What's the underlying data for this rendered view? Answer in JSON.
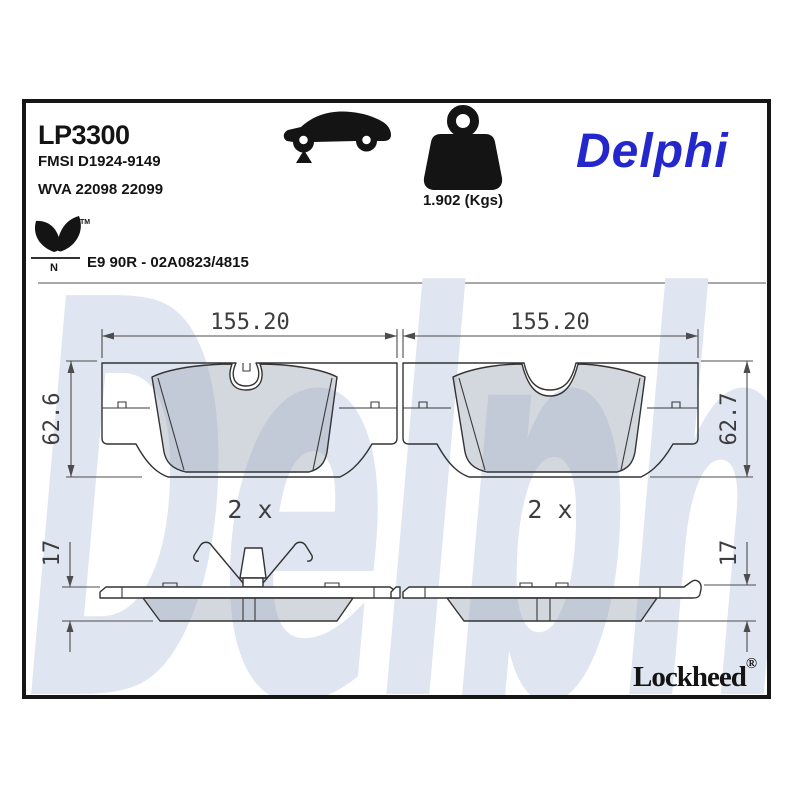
{
  "header": {
    "part_number": "LP3300",
    "fmsi": "FMSI D1924-9149",
    "wva": "WVA 22098 22099",
    "weight": "1.902 (Kgs)",
    "brand": "Delphi",
    "brand_color": "#2428cc",
    "car_icon": "sedan-silhouette-front-axle-indicator",
    "weight_icon": "weight-kettlebell"
  },
  "approval": {
    "label": "E9 90R - 02A0823/4815",
    "eco_icon": "leaf-logo",
    "eco_letter": "N",
    "trademark": "TM"
  },
  "drawing": {
    "watermark": "Delphi",
    "watermark_color": "#dfe5f1",
    "front_views": [
      {
        "name": "front-pad-left",
        "width_label": "155.20",
        "height_label": "62.6",
        "qty_label": "2 x"
      },
      {
        "name": "front-pad-right",
        "width_label": "155.20",
        "height_label": "62.7",
        "qty_label": "2 x"
      }
    ],
    "side_views": [
      {
        "name": "side-pad-left",
        "thickness_label": "17",
        "has_spring_clip": true
      },
      {
        "name": "side-pad-right",
        "thickness_label": "17",
        "has_spring_clip": false
      }
    ]
  },
  "footer": {
    "logo": "Lockheed",
    "registered": "®"
  }
}
